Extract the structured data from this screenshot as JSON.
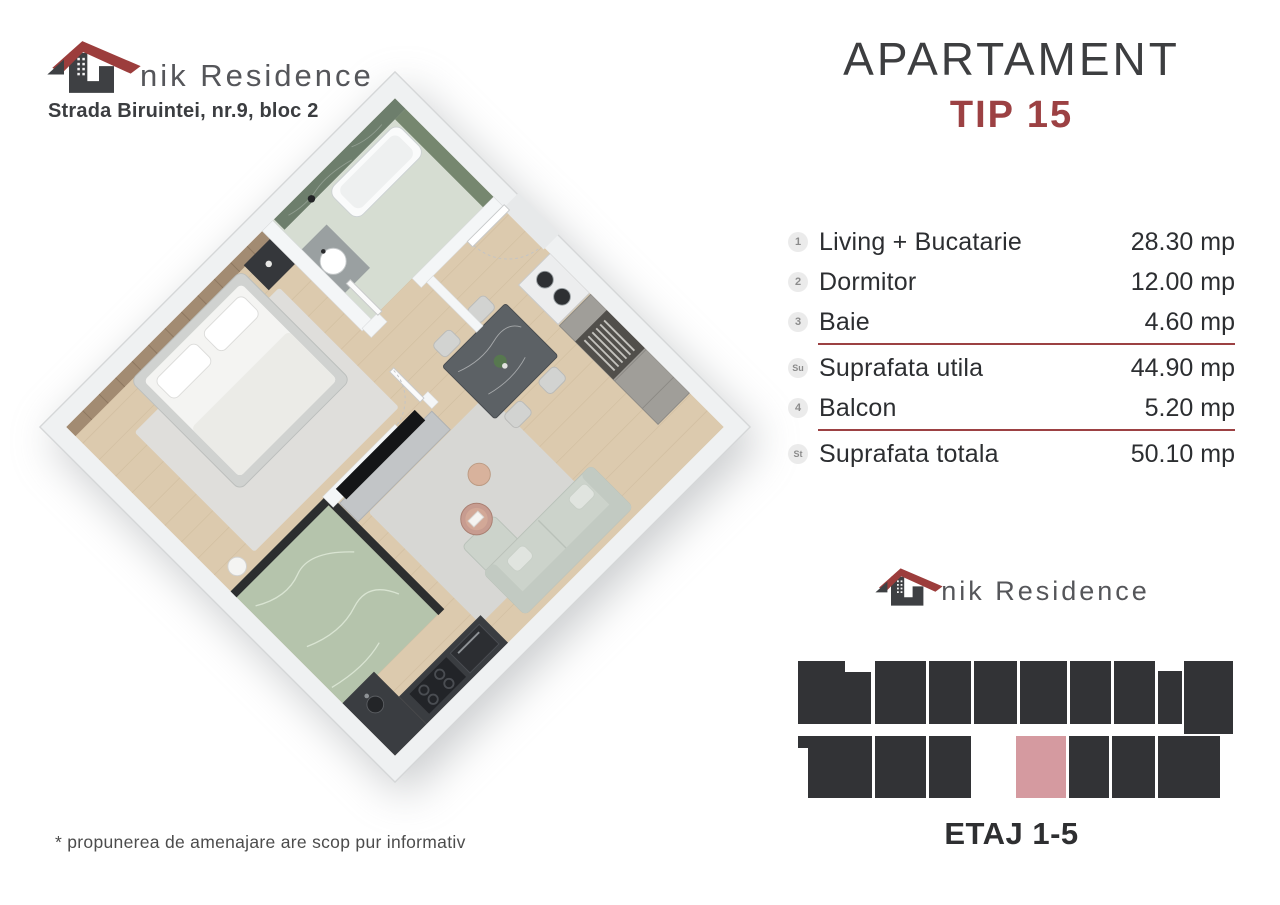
{
  "header": {
    "logo_text": "nik Residence",
    "address": "Strada Biruintei, nr.9, bloc 2"
  },
  "title": {
    "line1": "APARTAMENT",
    "line2": "TIP 15"
  },
  "areas": {
    "rows": [
      {
        "badge": "1",
        "label": "Living + Bucatarie",
        "value": "28.30 mp",
        "divider_after": false
      },
      {
        "badge": "2",
        "label": "Dormitor",
        "value": "12.00 mp",
        "divider_after": false
      },
      {
        "badge": "3",
        "label": "Baie",
        "value": "4.60 mp",
        "divider_after": true
      },
      {
        "badge": "Su",
        "label": "Suprafata utila",
        "value": "44.90 mp",
        "divider_after": false
      },
      {
        "badge": "4",
        "label": "Balcon",
        "value": "5.20 mp",
        "divider_after": true
      },
      {
        "badge": "St",
        "label": "Suprafata totala",
        "value": "50.10 mp",
        "divider_after": false
      }
    ]
  },
  "footer_logo": {
    "logo_text": "nik Residence"
  },
  "floor_label": "ETAJ 1-5",
  "disclaimer": "* propunerea de amenajare are scop pur informativ",
  "colors": {
    "accent_red": "#9c4143",
    "unit_dark": "#323336",
    "unit_highlight": "#d59aa0"
  },
  "building_diagram": {
    "highlighted_unit": "TIP 15",
    "blocks": [
      {
        "x": 0,
        "y": 3,
        "w": 47,
        "h": 63,
        "c": "dark"
      },
      {
        "x": 47,
        "y": 14,
        "w": 26,
        "h": 52,
        "c": "dark"
      },
      {
        "x": 77,
        "y": 3,
        "w": 51,
        "h": 63,
        "c": "dark"
      },
      {
        "x": 131,
        "y": 3,
        "w": 42,
        "h": 63,
        "c": "dark"
      },
      {
        "x": 176,
        "y": 3,
        "w": 43,
        "h": 63,
        "c": "dark"
      },
      {
        "x": 222,
        "y": 3,
        "w": 47,
        "h": 63,
        "c": "dark"
      },
      {
        "x": 272,
        "y": 3,
        "w": 41,
        "h": 63,
        "c": "dark"
      },
      {
        "x": 316,
        "y": 3,
        "w": 41,
        "h": 63,
        "c": "dark"
      },
      {
        "x": 360,
        "y": 13,
        "w": 24,
        "h": 53,
        "c": "dark"
      },
      {
        "x": 386,
        "y": 3,
        "w": 49,
        "h": 73,
        "c": "dark"
      },
      {
        "x": 0,
        "y": 78,
        "w": 74,
        "h": 12,
        "c": "dark"
      },
      {
        "x": 10,
        "y": 90,
        "w": 64,
        "h": 50,
        "c": "dark"
      },
      {
        "x": 77,
        "y": 78,
        "w": 51,
        "h": 62,
        "c": "dark"
      },
      {
        "x": 131,
        "y": 78,
        "w": 42,
        "h": 62,
        "c": "dark"
      },
      {
        "x": 218,
        "y": 78,
        "w": 50,
        "h": 62,
        "c": "pink"
      },
      {
        "x": 271,
        "y": 78,
        "w": 40,
        "h": 62,
        "c": "dark"
      },
      {
        "x": 314,
        "y": 78,
        "w": 43,
        "h": 62,
        "c": "dark"
      },
      {
        "x": 360,
        "y": 78,
        "w": 62,
        "h": 62,
        "c": "dark"
      }
    ]
  }
}
